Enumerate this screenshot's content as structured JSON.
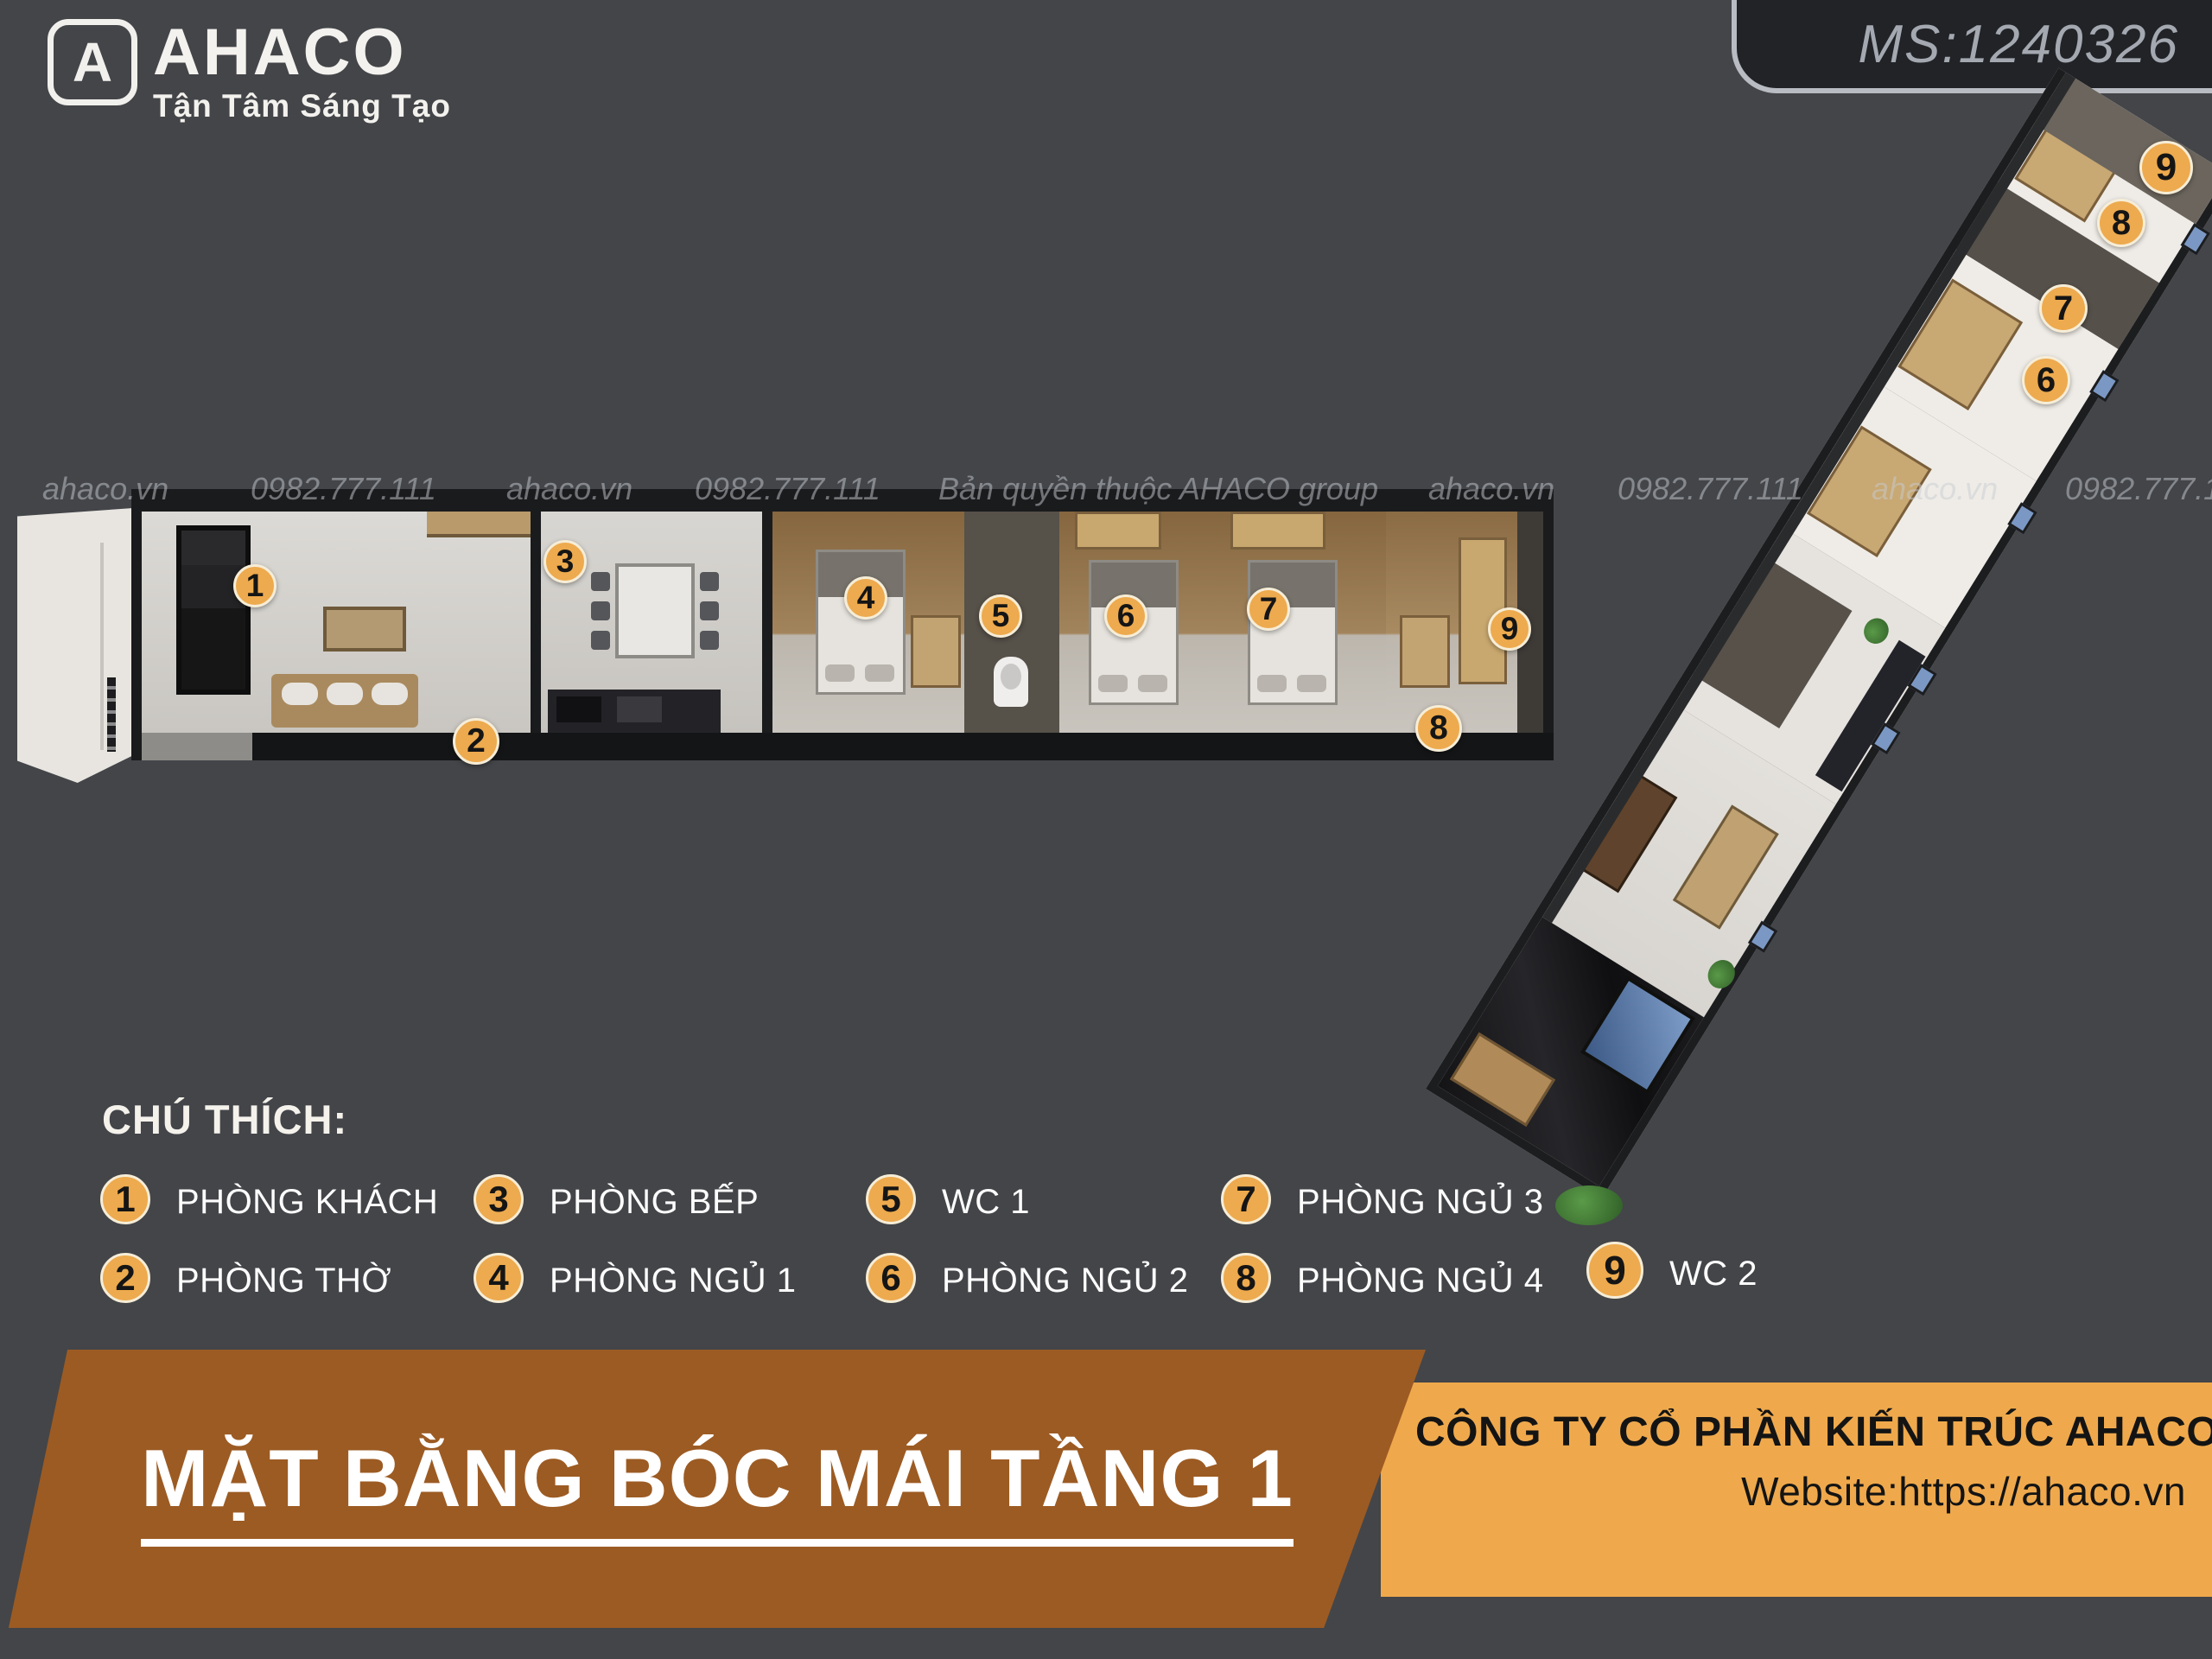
{
  "header": {
    "logo": {
      "icon_letter": "A",
      "brand": "AHACO",
      "tagline": "Tận Tâm Sáng Tạo"
    },
    "code_badge": "MS:1240326"
  },
  "watermarks": [
    "ahaco.vn",
    "0982.777.111",
    "ahaco.vn",
    "0982.777.111",
    "Bản quyền thuộc AHACO group",
    "ahaco.vn",
    "0982.777.111",
    "ahaco.vn",
    "0982.777.1"
  ],
  "plan_markers": {
    "horizontal": [
      "1",
      "2",
      "3",
      "4",
      "5",
      "6",
      "7",
      "8",
      "9"
    ],
    "diagonal": [
      "6",
      "7",
      "8",
      "9"
    ]
  },
  "legend": {
    "title": "CHÚ THÍCH:",
    "items": [
      {
        "num": "1",
        "label": "PHÒNG KHÁCH"
      },
      {
        "num": "2",
        "label": "PHÒNG THỜ"
      },
      {
        "num": "3",
        "label": "PHÒNG BẾP"
      },
      {
        "num": "4",
        "label": "PHÒNG NGỦ 1"
      },
      {
        "num": "5",
        "label": "WC 1"
      },
      {
        "num": "6",
        "label": "PHÒNG NGỦ 2"
      },
      {
        "num": "7",
        "label": "PHÒNG NGỦ 3"
      },
      {
        "num": "8",
        "label": "PHÒNG NGỦ 4"
      },
      {
        "num": "9",
        "label": "WC 2"
      }
    ]
  },
  "footer": {
    "title": "MẶT BẰNG BÓC MÁI TẦNG 1",
    "company": "CÔNG TY CỔ PHẦN KIẾN TRÚC AHACO",
    "website": "Website:https://ahaco.vn"
  },
  "colors": {
    "background": "#434549",
    "accent_orange": "#edaa4e",
    "banner_brown": "#9c5b23",
    "panel_orange": "#efa94c",
    "badge_bg": "#212327"
  }
}
